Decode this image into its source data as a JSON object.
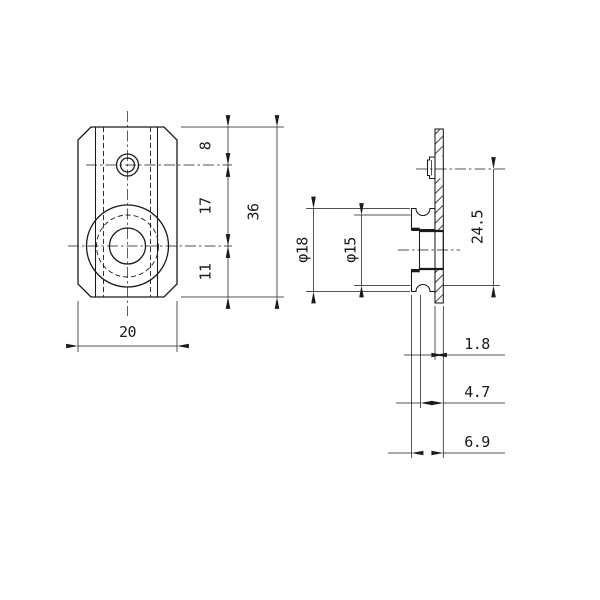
{
  "drawing": {
    "background": "#ffffff",
    "line_color": "#1a1a1a",
    "front_view": {
      "dim_top_to_small_hole": "8",
      "dim_small_to_large_hole": "17",
      "dim_large_hole_to_bottom": "11",
      "dim_total_height": "36",
      "dim_width": "20"
    },
    "side_view": {
      "dim_boss_outer_dia": "φ18",
      "dim_groove_dia": "φ15",
      "dim_center_to_groove_bottom": "24.5",
      "dim_plate_thickness": "1.8",
      "dim_hub_depth": "4.7",
      "dim_total_depth": "6.9"
    }
  }
}
